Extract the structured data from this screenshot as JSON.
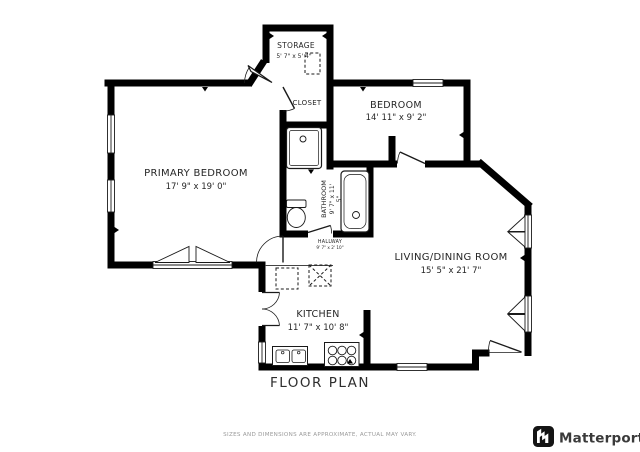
{
  "plan": {
    "title": "FLOOR PLAN",
    "rooms": {
      "storage": {
        "name": "STORAGE",
        "dims": "5' 7\" x 5' 4\""
      },
      "closet": {
        "name": "CLOSET"
      },
      "bedroom": {
        "name": "BEDROOM",
        "dims": "14' 11\" x 9' 2\""
      },
      "primary_bedroom": {
        "name": "PRIMARY BEDROOM",
        "dims": "17' 9\" x 19' 0\""
      },
      "bathroom": {
        "name": "BATHROOM",
        "dims_line1": "9' 7\" x 11'",
        "dims_line2": "5\""
      },
      "hallway": {
        "name": "HALLWAY",
        "dims": "9' 7\" x 2' 10\""
      },
      "living_dining": {
        "name": "LIVING/DINING ROOM",
        "dims": "15' 5\" x 21' 7\""
      },
      "kitchen": {
        "name": "KITCHEN",
        "dims": "11' 7\" x 10' 8\""
      }
    }
  },
  "footer": {
    "disclaimer": "SIZES AND DIMENSIONS ARE APPROXIMATE, ACTUAL MAY VARY.",
    "brand": "Matterport"
  },
  "colors": {
    "wall": "#000000",
    "label_text": "#262626",
    "muted_text": "#9a9a9a",
    "brand_text": "#3a3a3a"
  }
}
